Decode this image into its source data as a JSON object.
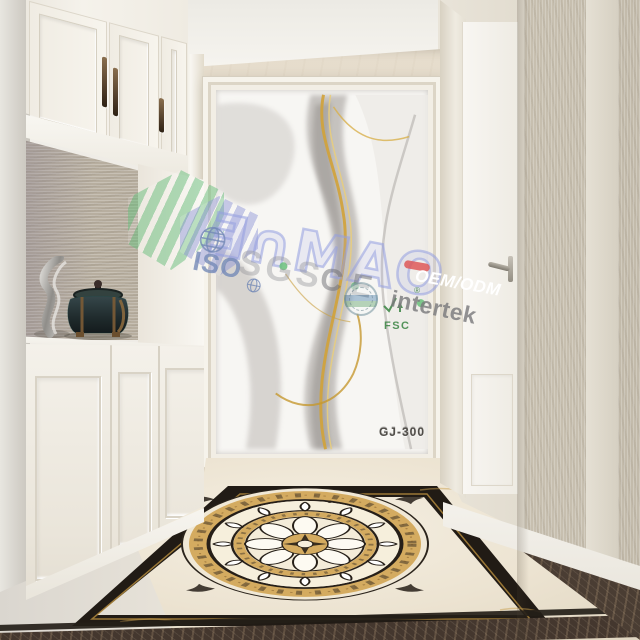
{
  "product": {
    "code": "GJ-300"
  },
  "watermarks": {
    "brand_text": "Ǝ∩MAO",
    "iso": "ISO",
    "sgs": "SGS",
    "ce": "CE",
    "oem_odm": "OEM/ODM",
    "intertek": "intertek",
    "fsc": "FSC",
    "fsc_registered": "®",
    "colors": {
      "logo_green": "#69be7d",
      "logo_purple": "#8c93d6",
      "brand_outline": "#949ee0",
      "iso_blue": "#7489b7",
      "sgs_gray": "#949499",
      "ce_gray": "#6c6c71",
      "oem_red": "#de5858",
      "intertek_gray": "#7a7a7d",
      "fsc_green": "#3e8646",
      "product_code_gray": "#514e49"
    }
  },
  "scene_colors": {
    "ceiling": "#f4f2ed",
    "back_wall_marble": "#e2d8c7",
    "cabinet_white": "#f3f0e9",
    "handle_bronze": "#4a3826",
    "backsplash_texture": "#b7ae9f",
    "art_gray": "#b3afab",
    "art_gold": "#d2a43c",
    "door_white": "#f6f4f0",
    "right_wall_texture": "#c7bfaf",
    "floor_cream": "#efe8d9",
    "medallion_tan": "#d4ab60",
    "medallion_black": "#261f18",
    "border_emperador": "#44372e"
  }
}
